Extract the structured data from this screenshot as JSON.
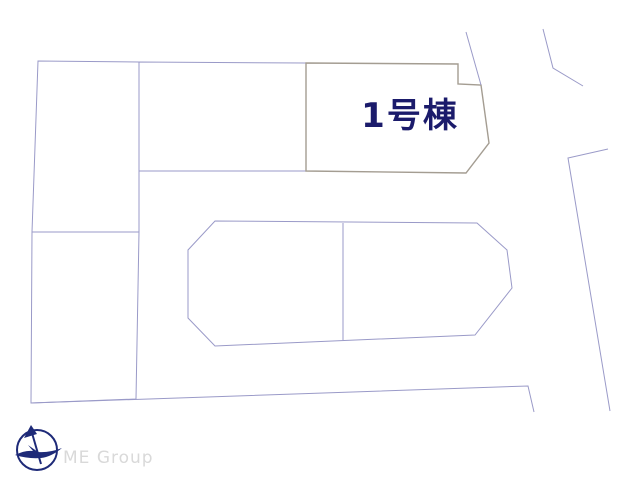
{
  "site_plan": {
    "highlighted_plot": {
      "label": "1号棟"
    },
    "colors": {
      "highlight_fill": "#f6d48c",
      "highlight_border": "#a49d92",
      "plot_line": "#9a9ac8",
      "highlight_label": "#1b1b6b"
    }
  },
  "footer": {
    "company": "ME Group",
    "compass_icon": "compass-north-arrow",
    "colors": {
      "logo": "#1e2a78",
      "company_text": "#d9d9d9"
    }
  }
}
